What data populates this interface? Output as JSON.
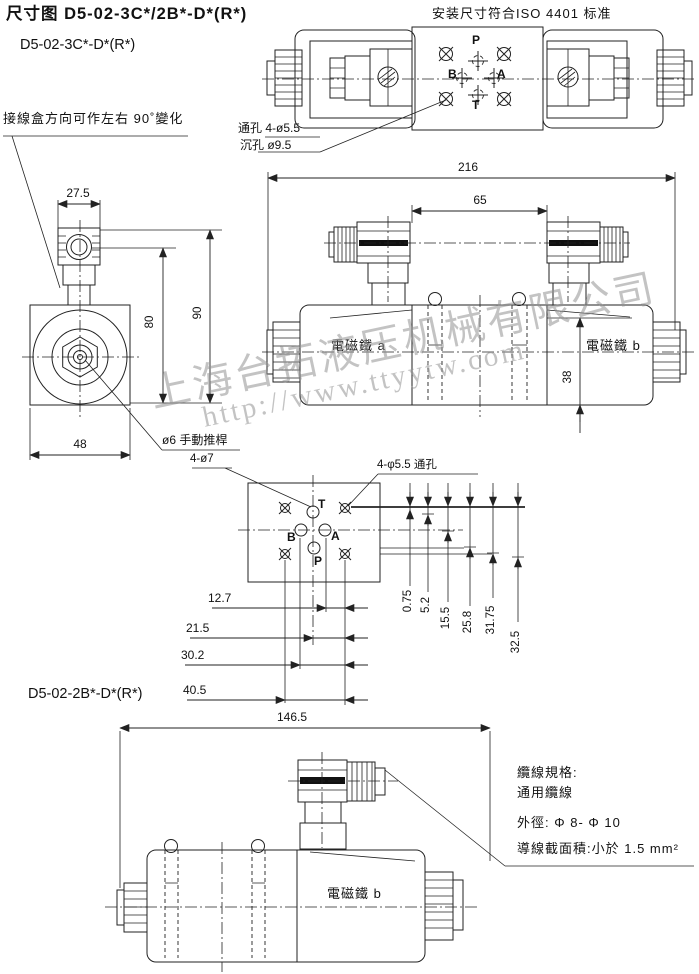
{
  "header": {
    "title": "尺寸图 D5-02-3C*/2B*-D*(R*)",
    "variant_3c_label": "D5-02-3C*-D*(R*)",
    "standard_note": "安装尺寸符合ISO 4401 标准"
  },
  "watermark": {
    "company": "上海台拓液压机械有限公司",
    "url": "http://www.ttyytw.com"
  },
  "top_view": {
    "port_p": "P",
    "port_b": "B",
    "port_a": "A",
    "port_t": "T",
    "through_hole_note": "通孔 4-ø5.5",
    "counterbore_note": "沉孔 ø9.5"
  },
  "end_view": {
    "junction_box_note": "接線盒方向可作左右 90˚變化",
    "manual_pin_note": "ø6 手動推桿",
    "dim_top_width": "27.5",
    "dim_height_80": "80",
    "dim_height_90": "90",
    "dim_bottom_width": "48"
  },
  "front_view": {
    "dim_overall": "216",
    "dim_connectors": "65",
    "dim_height_38": "38",
    "solenoid_a_label": "電磁鐵 a",
    "solenoid_b_label": "電磁鐵 b"
  },
  "plate_view": {
    "hole_note_7": "4-ø7",
    "hole_note_55": "4-φ5.5 通孔",
    "port_t": "T",
    "port_b": "B",
    "port_a": "A",
    "port_p": "P",
    "dims_horizontal": [
      "12.7",
      "21.5",
      "30.2",
      "40.5"
    ],
    "dims_vertical": [
      "0.75",
      "5.2",
      "15.5",
      "25.8",
      "31.75",
      "32.5"
    ]
  },
  "single_view": {
    "variant_2b_label": "D5-02-2B*-D*(R*)",
    "dim_overall": "146.5",
    "solenoid_b_label": "電磁鐵 b",
    "cable_note_title": "纜線規格:",
    "cable_note_type": "通用纜線",
    "cable_note_od": "外徑: Φ 8- Φ 10",
    "cable_note_area": "導線截面積:小於 1.5 mm²"
  }
}
